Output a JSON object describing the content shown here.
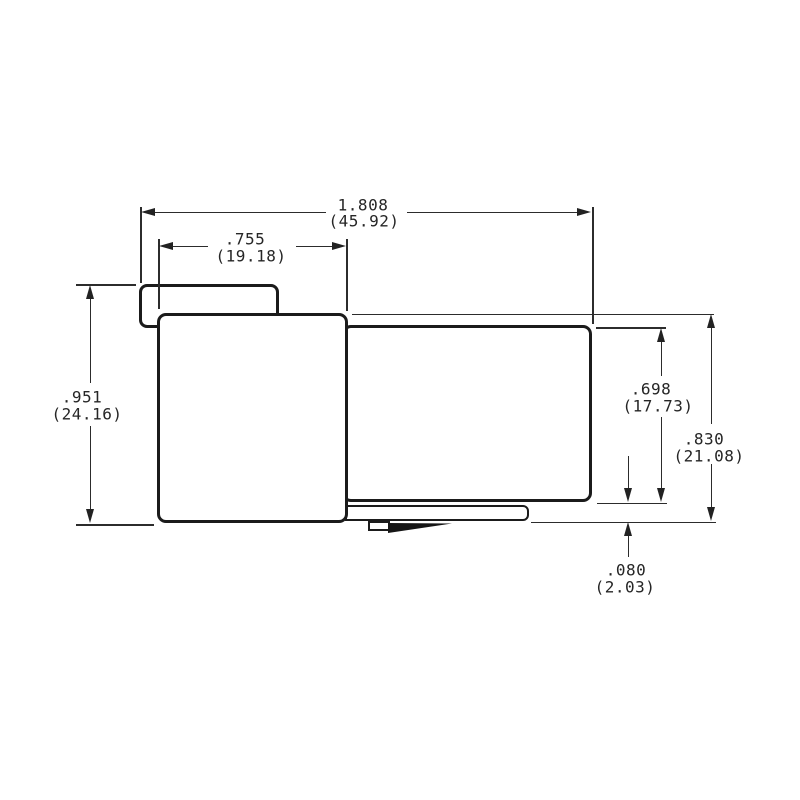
{
  "drawing": {
    "title": "connector-side-view-dimension-drawing",
    "units": "inches (millimeters)",
    "dimensions": {
      "overall_width": {
        "inch": "1.808",
        "mm": "(45.92)"
      },
      "tab_width": {
        "inch": ".755",
        "mm": "(19.18)"
      },
      "overall_height": {
        "inch": ".951",
        "mm": "(24.16)"
      },
      "right_body_height": {
        "inch": ".698",
        "mm": "(17.73)"
      },
      "body_height": {
        "inch": ".830",
        "mm": "(21.08)"
      },
      "bottom_offset": {
        "inch": ".080",
        "mm": "(2.03)"
      }
    }
  }
}
